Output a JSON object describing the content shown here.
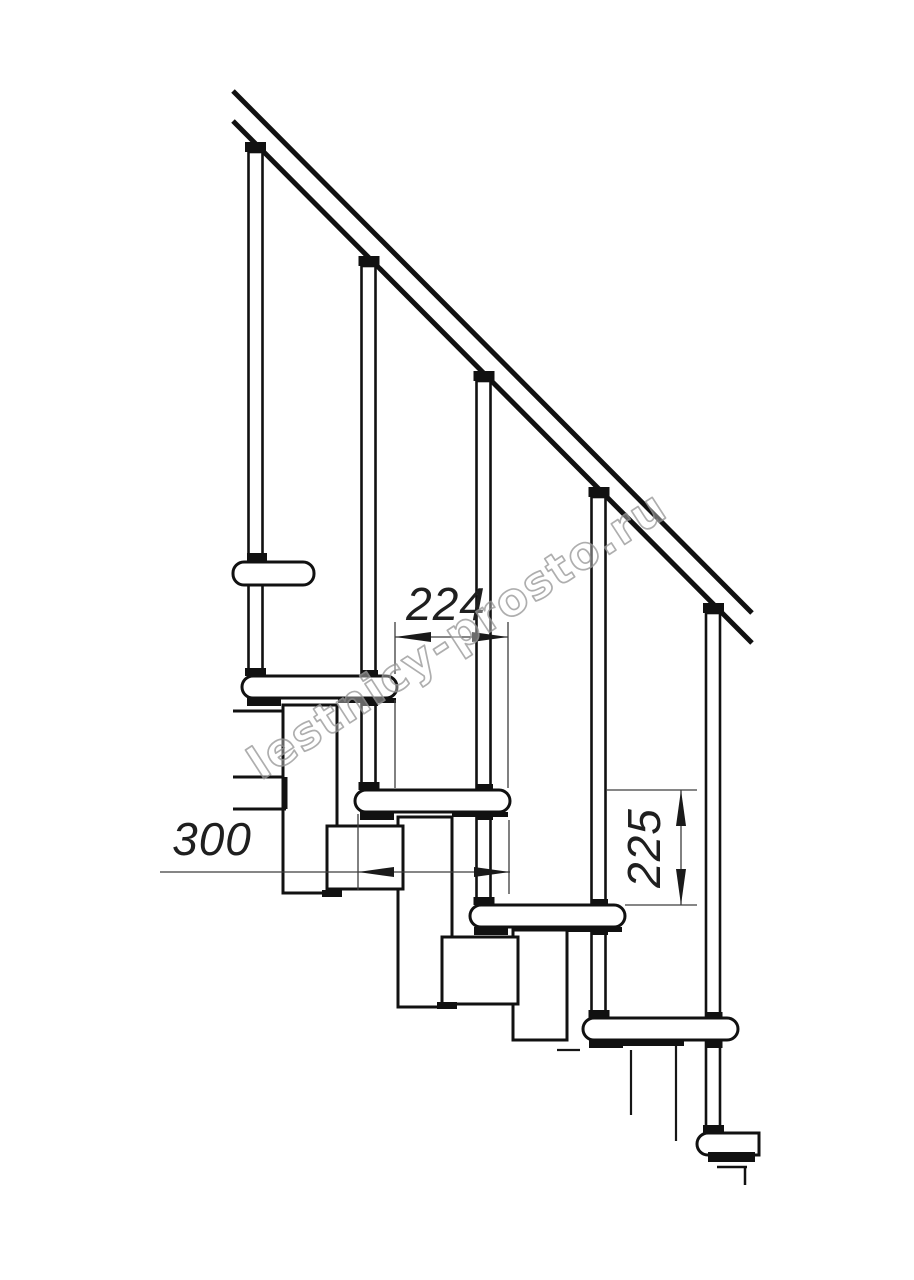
{
  "watermark": {
    "text": "lestnicy-prosto.ru"
  },
  "dimensions": {
    "horizontal_upper": {
      "value": "224"
    },
    "tread_depth": {
      "value": "300"
    },
    "riser_height": {
      "value": "225"
    }
  },
  "colors": {
    "line": "#111111",
    "dimension_line": "#3d3d3d",
    "dimension_text": "#1f1f1f",
    "watermark_stroke": "#9b9b9b",
    "background": "#ffffff"
  }
}
